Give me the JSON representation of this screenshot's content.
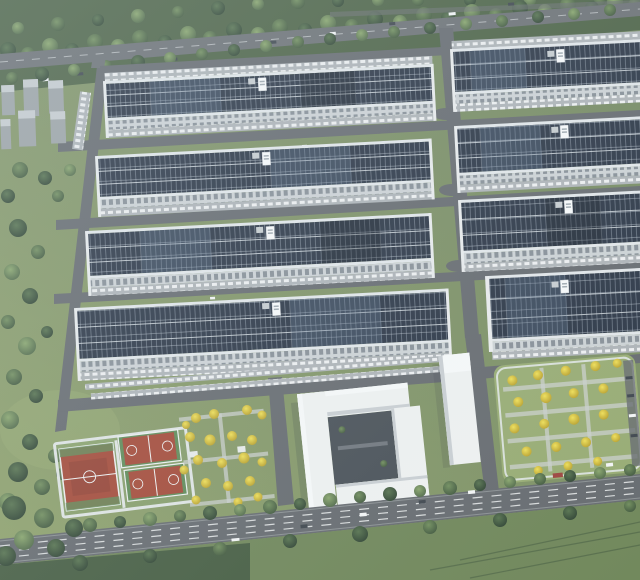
{
  "scene": {
    "type": "aerial-architectural-rendering",
    "description": "Bird's-eye rendering of an industrial park: eight long warehouses with dark solar-panel rooftops in two columns separated by internal roads, a tree belt and highway at top, gray tower blocks at upper left, red sports courts, a white pinwheel office complex with tower, a landscaped parking garden with yellow trees, and a tree-lined main road with vehicles at the bottom.",
    "objects": {
      "warehouse_count": 8,
      "solar_rooftops": true,
      "rooftop_signs": 8,
      "multipurpose_courts": 1,
      "basketball_courts": 2,
      "office_buildings": 2,
      "gray_tower_blocks": 6,
      "yellow_tree_garden": true,
      "roads_with_cars": 2
    },
    "colors": {
      "grass": "#7E9260",
      "grass-light": "#96AA6F",
      "tree-belt": "#495F40",
      "tree-dark": "#2F4431",
      "tree-mid": "#5C774B",
      "tree-light": "#76925B",
      "tree-yellow": "#E9D440",
      "road": "#63676B",
      "road-light": "#9AA09F",
      "highway": "#696D70",
      "apron": "#ADB2B5",
      "wall": "#CDD2D4",
      "wall-bright": "#EAECEC",
      "parapet": "#E3E7E9",
      "panel-dark": "#273140",
      "panel-light": "#5A6F88",
      "block-gray": "#9BA1A3",
      "block-top": "#C7CCCE",
      "court-red": "#A34532",
      "court-red-dark": "#8C3A2C",
      "court-green": "#5C8852",
      "court-frame": "#E0E5E3",
      "office-white": "#F0F2F1",
      "office-shade": "#C9CED1",
      "office-top": "#F8FAF9",
      "courtyard": "#454C52",
      "field": "#6D8455",
      "field-dark": "#3B5138",
      "car-white": "#F5F6F6",
      "car-dark": "#3A4148",
      "car-red": "#9C4038",
      "sign": "#FAFBFB"
    }
  }
}
